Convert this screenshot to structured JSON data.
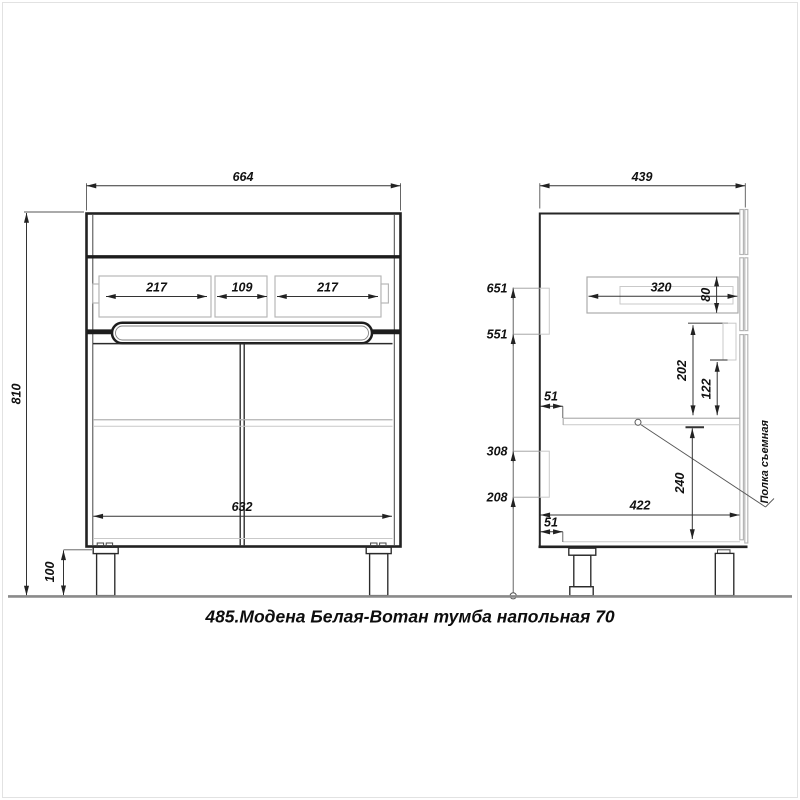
{
  "title": "485.Модена Белая-Вотан тумба напольная 70",
  "front_view": {
    "overall_width": "664",
    "overall_height": "810",
    "leg_height": "100",
    "doors_width": "632",
    "drawer_sections": [
      "217",
      "109",
      "217"
    ]
  },
  "side_view": {
    "overall_depth": "439",
    "drawer_depth": "320",
    "drawer_side_height": "80",
    "height_marks": [
      "651",
      "551",
      "308",
      "208"
    ],
    "shelf_front_inset": "51",
    "bottom_front_inset": "51",
    "drawer_to_shelf": "202",
    "notch_to_shelf": "122",
    "shelf_to_bottom": "240",
    "inner_depth": "422",
    "shelf_note": "Полка съемная"
  },
  "colors": {
    "line": "#222222",
    "light_line": "#c3c3c3",
    "floor": "#8a8a8a",
    "dim_text": "#111111"
  }
}
